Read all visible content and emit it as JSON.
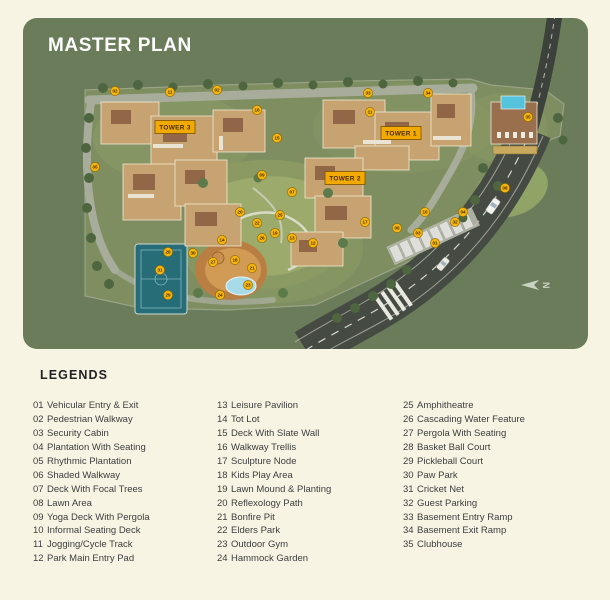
{
  "page": {
    "title": "MASTER PLAN"
  },
  "legend": {
    "heading": "LEGENDS",
    "columns": [
      [
        {
          "num": "01",
          "label": "Vehicular Entry & Exit"
        },
        {
          "num": "02",
          "label": "Pedestrian Walkway"
        },
        {
          "num": "03",
          "label": "Security Cabin"
        },
        {
          "num": "04",
          "label": "Plantation With Seating"
        },
        {
          "num": "05",
          "label": "Rhythmic Plantation"
        },
        {
          "num": "06",
          "label": "Shaded Walkway"
        },
        {
          "num": "07",
          "label": "Deck With Focal Trees"
        },
        {
          "num": "08",
          "label": "Lawn Area"
        },
        {
          "num": "09",
          "label": "Yoga Deck With Pergola"
        },
        {
          "num": "10",
          "label": "Informal Seating Deck"
        },
        {
          "num": "11",
          "label": "Jogging/Cycle Track"
        },
        {
          "num": "12",
          "label": "Park Main Entry Pad"
        }
      ],
      [
        {
          "num": "13",
          "label": "Leisure Pavilion"
        },
        {
          "num": "14",
          "label": "Tot Lot"
        },
        {
          "num": "15",
          "label": "Deck With Slate Wall"
        },
        {
          "num": "16",
          "label": "Walkway Trellis"
        },
        {
          "num": "17",
          "label": "Sculpture Node"
        },
        {
          "num": "18",
          "label": "Kids Play Area"
        },
        {
          "num": "19",
          "label": "Lawn Mound & Planting"
        },
        {
          "num": "20",
          "label": "Reflexology Path"
        },
        {
          "num": "21",
          "label": "Bonfire Pit"
        },
        {
          "num": "22",
          "label": "Elders Park"
        },
        {
          "num": "23",
          "label": "Outdoor Gym"
        },
        {
          "num": "24",
          "label": "Hammock Garden"
        }
      ],
      [
        {
          "num": "25",
          "label": "Amphitheatre"
        },
        {
          "num": "26",
          "label": "Cascading Water Feature"
        },
        {
          "num": "27",
          "label": "Pergola With Seating"
        },
        {
          "num": "28",
          "label": "Basket Ball Court"
        },
        {
          "num": "29",
          "label": "Pickleball Court"
        },
        {
          "num": "30",
          "label": "Paw Park"
        },
        {
          "num": "31",
          "label": "Cricket Net"
        },
        {
          "num": "32",
          "label": "Guest Parking"
        },
        {
          "num": "33",
          "label": "Basement Entry Ramp"
        },
        {
          "num": "34",
          "label": "Basement Exit Ramp"
        },
        {
          "num": "35",
          "label": "Clubhouse"
        }
      ]
    ]
  },
  "map": {
    "towers": [
      {
        "label": "TOWER 3",
        "x": 152,
        "y": 109
      },
      {
        "label": "TOWER 1",
        "x": 378,
        "y": 115
      },
      {
        "label": "TOWER 2",
        "x": 322,
        "y": 160
      }
    ],
    "compass": {
      "label": "N"
    },
    "colors": {
      "panel": "#6a7c59",
      "marker": "#f6b40e",
      "markerBorder": "#8a6a00",
      "markerText": "#4a3000",
      "towerBg": "#f2a900",
      "towerBorder": "#7a5200",
      "towerText": "#4b2e00"
    },
    "markers": [
      {
        "n": "02",
        "x": 92,
        "y": 73
      },
      {
        "n": "11",
        "x": 147,
        "y": 74
      },
      {
        "n": "02",
        "x": 194,
        "y": 72
      },
      {
        "n": "16",
        "x": 234,
        "y": 92
      },
      {
        "n": "15",
        "x": 254,
        "y": 120
      },
      {
        "n": "33",
        "x": 345,
        "y": 75
      },
      {
        "n": "34",
        "x": 405,
        "y": 75
      },
      {
        "n": "11",
        "x": 347,
        "y": 94
      },
      {
        "n": "35",
        "x": 505,
        "y": 99
      },
      {
        "n": "05",
        "x": 72,
        "y": 149
      },
      {
        "n": "09",
        "x": 239,
        "y": 157
      },
      {
        "n": "07",
        "x": 269,
        "y": 174
      },
      {
        "n": "08",
        "x": 482,
        "y": 170
      },
      {
        "n": "04",
        "x": 440,
        "y": 194
      },
      {
        "n": "10",
        "x": 402,
        "y": 194
      },
      {
        "n": "06",
        "x": 374,
        "y": 210
      },
      {
        "n": "32",
        "x": 432,
        "y": 204
      },
      {
        "n": "03",
        "x": 395,
        "y": 215
      },
      {
        "n": "01",
        "x": 412,
        "y": 225
      },
      {
        "n": "12",
        "x": 290,
        "y": 225
      },
      {
        "n": "17",
        "x": 342,
        "y": 204
      },
      {
        "n": "20",
        "x": 217,
        "y": 194
      },
      {
        "n": "25",
        "x": 257,
        "y": 197
      },
      {
        "n": "22",
        "x": 234,
        "y": 205
      },
      {
        "n": "19",
        "x": 252,
        "y": 215
      },
      {
        "n": "26",
        "x": 239,
        "y": 220
      },
      {
        "n": "13",
        "x": 269,
        "y": 220
      },
      {
        "n": "14",
        "x": 199,
        "y": 222
      },
      {
        "n": "18",
        "x": 212,
        "y": 242
      },
      {
        "n": "21",
        "x": 229,
        "y": 250
      },
      {
        "n": "23",
        "x": 225,
        "y": 267
      },
      {
        "n": "24",
        "x": 197,
        "y": 277
      },
      {
        "n": "27",
        "x": 190,
        "y": 244
      },
      {
        "n": "30",
        "x": 170,
        "y": 235
      },
      {
        "n": "28",
        "x": 145,
        "y": 234
      },
      {
        "n": "31",
        "x": 137,
        "y": 252
      },
      {
        "n": "29",
        "x": 145,
        "y": 277
      }
    ]
  }
}
